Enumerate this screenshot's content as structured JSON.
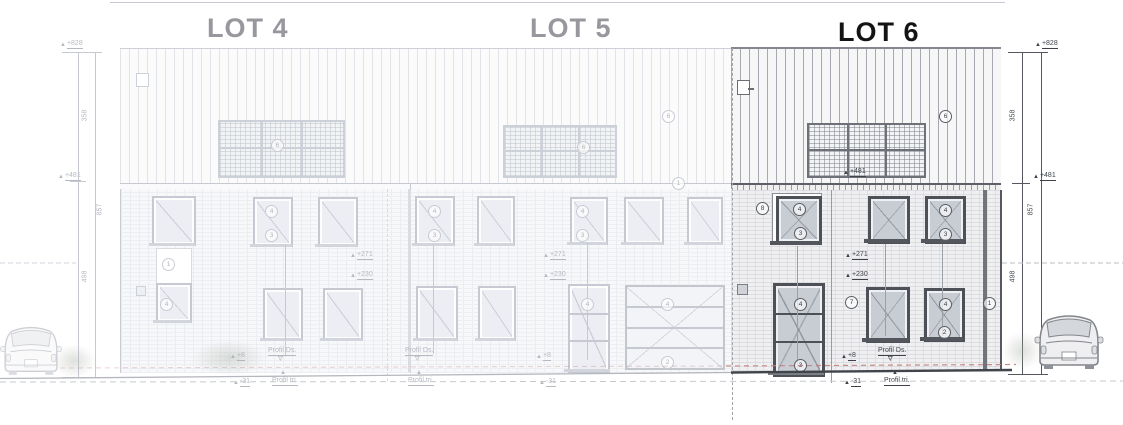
{
  "titles": {
    "lot4": "LOT 4",
    "lot5": "LOT 5",
    "lot6": "LOT 6"
  },
  "dims": {
    "ridge_level": "+828",
    "roof_height": "358",
    "eave_level": "+481",
    "total_height": "857",
    "wall_height": "498"
  },
  "levels": {
    "eave": "+481",
    "floor": "+271",
    "lintel": "+230",
    "plinth": "+8",
    "terrain": "-31",
    "profile_top": "Profil Ds.",
    "profile_bottom": "Profil tri."
  },
  "bubbles": {
    "solar": "6",
    "roof": "6",
    "gutter": "1",
    "wall": "8",
    "window": "4",
    "sill": "3",
    "door": "4",
    "stair": "1",
    "wall_ground": "7",
    "window_ground": "4",
    "sill_ground": "2",
    "downpipe": "1"
  },
  "colors": {
    "highlight_line": "#4d5157",
    "faded_line": "#c6c9d1",
    "ground_red": "#c4807f",
    "title_gray": "#97979d",
    "title_black": "#141414"
  }
}
